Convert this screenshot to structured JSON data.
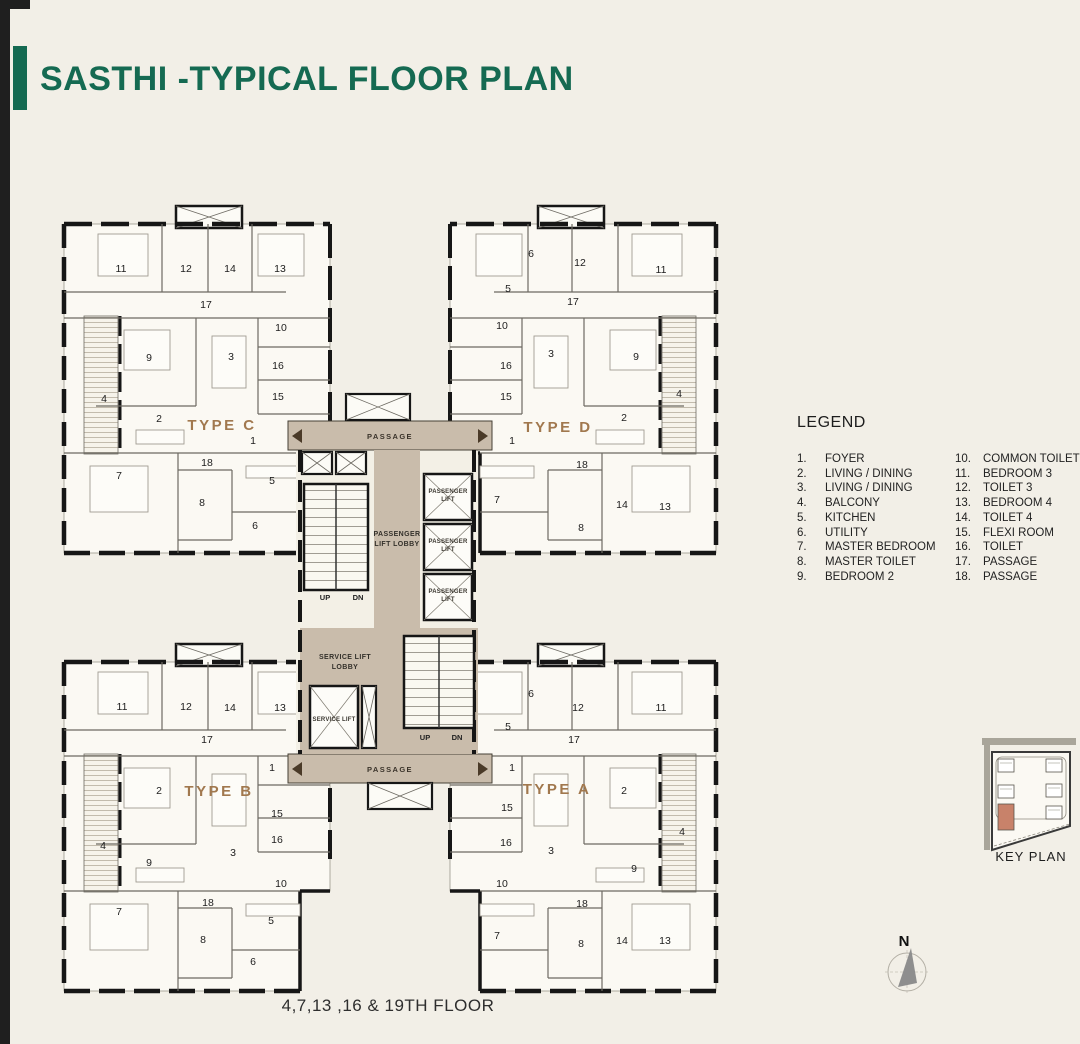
{
  "title": "SASTHI -TYPICAL FLOOR PLAN",
  "footer": "4,7,13 ,16 & 19TH FLOOR",
  "legend": {
    "title": "LEGEND",
    "columns": [
      [
        {
          "n": "1.",
          "label": "FOYER"
        },
        {
          "n": "2.",
          "label": "LIVING / DINING"
        },
        {
          "n": "3.",
          "label": "LIVING / DINING"
        },
        {
          "n": "4.",
          "label": "BALCONY"
        },
        {
          "n": "5.",
          "label": "KITCHEN"
        },
        {
          "n": "6.",
          "label": "UTILITY"
        },
        {
          "n": "7.",
          "label": "MASTER BEDROOM"
        },
        {
          "n": "8.",
          "label": "MASTER TOILET"
        },
        {
          "n": "9.",
          "label": "BEDROOM 2"
        }
      ],
      [
        {
          "n": "10.",
          "label": "COMMON TOILET"
        },
        {
          "n": "11.",
          "label": "BEDROOM 3"
        },
        {
          "n": "12.",
          "label": "TOILET 3"
        },
        {
          "n": "13.",
          "label": "BEDROOM 4"
        },
        {
          "n": "14.",
          "label": "TOILET 4"
        },
        {
          "n": "15.",
          "label": "FLEXI ROOM"
        },
        {
          "n": "16.",
          "label": "TOILET"
        },
        {
          "n": "17.",
          "label": "PASSAGE"
        },
        {
          "n": "18.",
          "label": "PASSAGE"
        }
      ]
    ]
  },
  "key_plan": {
    "label": "KEY PLAN"
  },
  "north": {
    "label": "N"
  },
  "plan": {
    "colors": {
      "green": "#156a52",
      "tan": "#c9bcab",
      "brown": "#a1784e",
      "salmon": "#c8826a",
      "bg": "#f2efe7",
      "paper": "#fbf9f3"
    },
    "type_labels": [
      {
        "t": "TYPE C",
        "x": 222,
        "y": 430
      },
      {
        "t": "TYPE D",
        "x": 558,
        "y": 432
      },
      {
        "t": "TYPE B",
        "x": 219,
        "y": 796
      },
      {
        "t": "TYPE A",
        "x": 557,
        "y": 794
      }
    ],
    "room_labels": [
      {
        "t": "11",
        "x": 121,
        "y": 272
      },
      {
        "t": "12",
        "x": 186,
        "y": 272
      },
      {
        "t": "14",
        "x": 230,
        "y": 272
      },
      {
        "t": "13",
        "x": 280,
        "y": 272
      },
      {
        "t": "17",
        "x": 206,
        "y": 308
      },
      {
        "t": "10",
        "x": 281,
        "y": 331
      },
      {
        "t": "9",
        "x": 149,
        "y": 361
      },
      {
        "t": "3",
        "x": 231,
        "y": 360
      },
      {
        "t": "16",
        "x": 278,
        "y": 369
      },
      {
        "t": "15",
        "x": 278,
        "y": 400
      },
      {
        "t": "4",
        "x": 104,
        "y": 402
      },
      {
        "t": "2",
        "x": 159,
        "y": 422
      },
      {
        "t": "1",
        "x": 253,
        "y": 444
      },
      {
        "t": "18",
        "x": 207,
        "y": 466
      },
      {
        "t": "7",
        "x": 119,
        "y": 479
      },
      {
        "t": "5",
        "x": 272,
        "y": 484
      },
      {
        "t": "8",
        "x": 202,
        "y": 506
      },
      {
        "t": "6",
        "x": 255,
        "y": 529
      },
      {
        "t": "6",
        "x": 531,
        "y": 257
      },
      {
        "t": "12",
        "x": 580,
        "y": 266
      },
      {
        "t": "11",
        "x": 661,
        "y": 273
      },
      {
        "t": "5",
        "x": 508,
        "y": 292
      },
      {
        "t": "17",
        "x": 573,
        "y": 305
      },
      {
        "t": "10",
        "x": 502,
        "y": 329
      },
      {
        "t": "3",
        "x": 551,
        "y": 357
      },
      {
        "t": "9",
        "x": 636,
        "y": 360
      },
      {
        "t": "16",
        "x": 506,
        "y": 369
      },
      {
        "t": "15",
        "x": 506,
        "y": 400
      },
      {
        "t": "4",
        "x": 679,
        "y": 397
      },
      {
        "t": "2",
        "x": 624,
        "y": 421
      },
      {
        "t": "1",
        "x": 512,
        "y": 444
      },
      {
        "t": "18",
        "x": 582,
        "y": 468
      },
      {
        "t": "7",
        "x": 497,
        "y": 503
      },
      {
        "t": "14",
        "x": 622,
        "y": 508
      },
      {
        "t": "13",
        "x": 665,
        "y": 510
      },
      {
        "t": "8",
        "x": 581,
        "y": 531
      },
      {
        "t": "11",
        "x": 122,
        "y": 710
      },
      {
        "t": "12",
        "x": 186,
        "y": 710
      },
      {
        "t": "14",
        "x": 230,
        "y": 711
      },
      {
        "t": "13",
        "x": 280,
        "y": 711
      },
      {
        "t": "17",
        "x": 207,
        "y": 743
      },
      {
        "t": "1",
        "x": 272,
        "y": 771
      },
      {
        "t": "2",
        "x": 159,
        "y": 794
      },
      {
        "t": "15",
        "x": 277,
        "y": 817
      },
      {
        "t": "16",
        "x": 277,
        "y": 843
      },
      {
        "t": "4",
        "x": 103,
        "y": 849
      },
      {
        "t": "3",
        "x": 233,
        "y": 856
      },
      {
        "t": "9",
        "x": 149,
        "y": 866
      },
      {
        "t": "10",
        "x": 281,
        "y": 887
      },
      {
        "t": "18",
        "x": 208,
        "y": 906
      },
      {
        "t": "7",
        "x": 119,
        "y": 915
      },
      {
        "t": "5",
        "x": 271,
        "y": 924
      },
      {
        "t": "8",
        "x": 203,
        "y": 943
      },
      {
        "t": "6",
        "x": 253,
        "y": 965
      },
      {
        "t": "6",
        "x": 531,
        "y": 697
      },
      {
        "t": "12",
        "x": 578,
        "y": 711
      },
      {
        "t": "11",
        "x": 661,
        "y": 711
      },
      {
        "t": "5",
        "x": 508,
        "y": 730
      },
      {
        "t": "17",
        "x": 574,
        "y": 743
      },
      {
        "t": "1",
        "x": 512,
        "y": 771
      },
      {
        "t": "2",
        "x": 624,
        "y": 794
      },
      {
        "t": "15",
        "x": 507,
        "y": 811
      },
      {
        "t": "4",
        "x": 682,
        "y": 835
      },
      {
        "t": "16",
        "x": 506,
        "y": 846
      },
      {
        "t": "3",
        "x": 551,
        "y": 854
      },
      {
        "t": "9",
        "x": 634,
        "y": 872
      },
      {
        "t": "10",
        "x": 502,
        "y": 887
      },
      {
        "t": "18",
        "x": 582,
        "y": 907
      },
      {
        "t": "7",
        "x": 497,
        "y": 939
      },
      {
        "t": "14",
        "x": 622,
        "y": 944
      },
      {
        "t": "8",
        "x": 581,
        "y": 947
      },
      {
        "t": "13",
        "x": 665,
        "y": 944
      }
    ],
    "core_labels": [
      {
        "t": "PASSAGE",
        "x": 390,
        "y": 439,
        "cls": "lbl-passage"
      },
      {
        "t": "PASSAGE",
        "x": 390,
        "y": 772,
        "cls": "lbl-passage"
      },
      {
        "t": "PASSENGER",
        "x": 397,
        "y": 536,
        "cls": "lbl-sm"
      },
      {
        "t": "LIFT LOBBY",
        "x": 397,
        "y": 546,
        "cls": "lbl-sm"
      },
      {
        "t": "PASSENGER",
        "x": 448,
        "y": 493,
        "cls": "lbl-xs"
      },
      {
        "t": "LIFT",
        "x": 448,
        "y": 501,
        "cls": "lbl-xs"
      },
      {
        "t": "PASSENGER",
        "x": 448,
        "y": 543,
        "cls": "lbl-xs"
      },
      {
        "t": "LIFT",
        "x": 448,
        "y": 551,
        "cls": "lbl-xs"
      },
      {
        "t": "PASSENGER",
        "x": 448,
        "y": 593,
        "cls": "lbl-xs"
      },
      {
        "t": "LIFT",
        "x": 448,
        "y": 601,
        "cls": "lbl-xs"
      },
      {
        "t": "UP",
        "x": 325,
        "y": 600,
        "cls": "lbl-updn"
      },
      {
        "t": "DN",
        "x": 358,
        "y": 600,
        "cls": "lbl-updn"
      },
      {
        "t": "SERVICE LIFT",
        "x": 345,
        "y": 659,
        "cls": "lbl-sm"
      },
      {
        "t": "LOBBY",
        "x": 345,
        "y": 669,
        "cls": "lbl-sm"
      },
      {
        "t": "SERVICE LIFT",
        "x": 334,
        "y": 721,
        "cls": "lbl-xs"
      },
      {
        "t": "UP",
        "x": 425,
        "y": 740,
        "cls": "lbl-updn"
      },
      {
        "t": "DN",
        "x": 457,
        "y": 740,
        "cls": "lbl-updn"
      }
    ]
  }
}
